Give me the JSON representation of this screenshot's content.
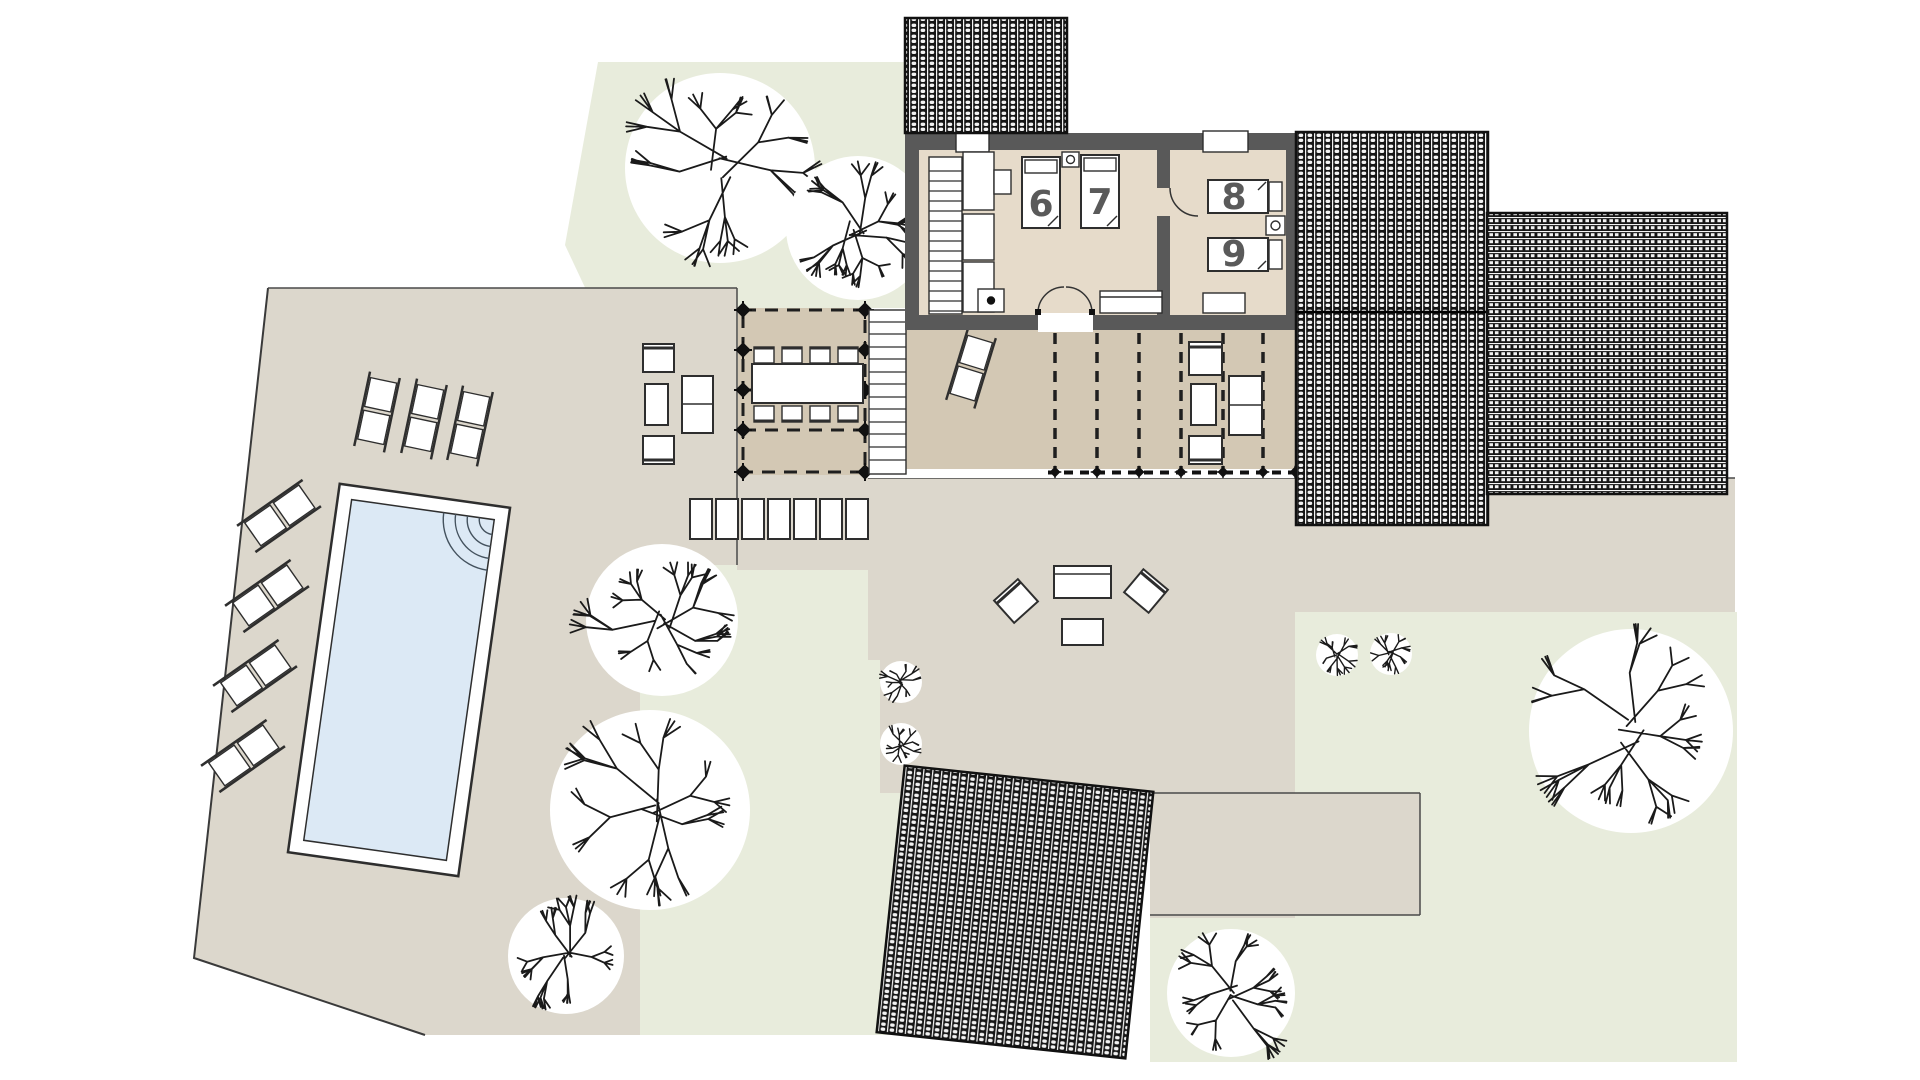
{
  "plan": {
    "type": "villa-site-floor-plan",
    "rooms": [
      {
        "id": "room-6",
        "label": "6"
      },
      {
        "id": "room-7",
        "label": "7"
      },
      {
        "id": "room-8",
        "label": "8"
      },
      {
        "id": "room-9",
        "label": "9"
      }
    ]
  },
  "colors": {
    "lawn": "#e8ecdc",
    "paving": "#dcd7cc",
    "deck": "#d3c8b4",
    "floor": "#e6dbca",
    "wall": "#595959",
    "water": "#dce9f5",
    "roof_dark": "#161616",
    "label": "#5a5a5a"
  }
}
